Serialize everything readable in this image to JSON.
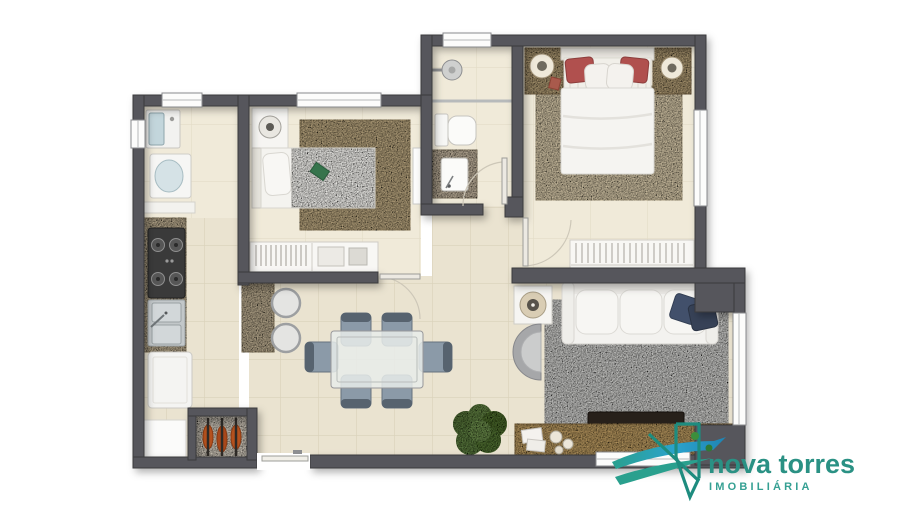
{
  "brand": {
    "name": "nova torres",
    "tagline": "IMOBILIÁRIA",
    "colors": {
      "wordmark_teal": "#2a9184",
      "tagline_teal": "#35a093",
      "mark_outline_teal": "#1e8c7f",
      "swoosh_blue": "#2ba3cc",
      "swoosh_teal": "#2aa08e"
    }
  },
  "floorplan": {
    "type": "apartment-floor-plan-top-view",
    "wall_color": "#56575b",
    "floor_tile_color": "#eae3d0",
    "accent_colors": {
      "wood_counter": "#b2a489",
      "bedroom_rug": "#b3a07b",
      "master_rug": "#cdc0a2",
      "living_rug": "#c7c7c5",
      "red_pillow": "#b0504e",
      "navy_pillow": "#42506b",
      "bbq_meat": "#b5511d",
      "plant_green": "#5a7840",
      "tv_rack_wood": "#b3945f"
    },
    "rooms": [
      "laundry",
      "kitchen",
      "bedroom",
      "bathroom",
      "hallway",
      "master-bedroom",
      "living-room",
      "dining-area"
    ],
    "furniture": [
      "washing-machine",
      "laundry-tub",
      "stove",
      "double-sink",
      "refrigerator",
      "barbecue-grill",
      "breakfast-counter",
      "bar-stools",
      "single-bed",
      "wardrobe",
      "nightstand",
      "double-bed",
      "toilet",
      "shower",
      "vanity-sink",
      "dining-table",
      "dining-chairs",
      "sofa",
      "armchair",
      "side-table-lamp",
      "tv-rack",
      "tv",
      "plant"
    ]
  }
}
